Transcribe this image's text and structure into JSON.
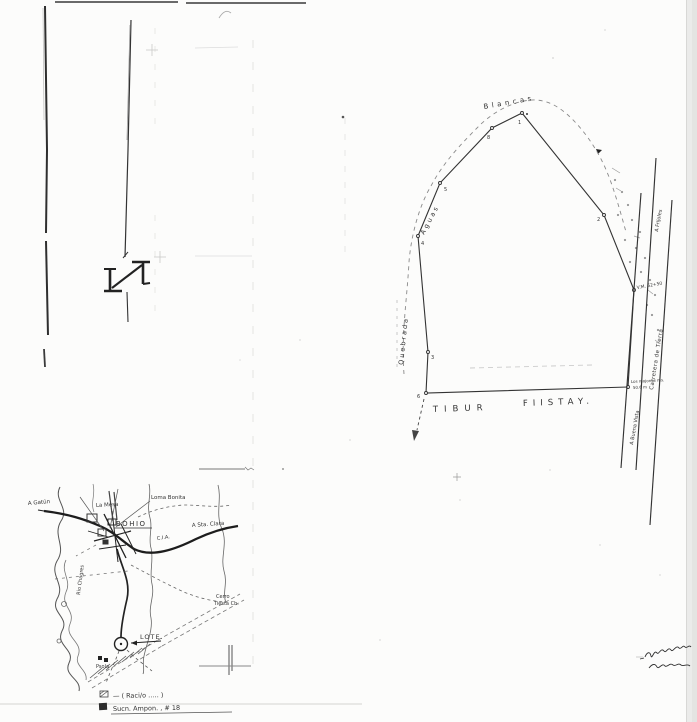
{
  "plat": {
    "creek_word_quebrada": "Quebrada",
    "creek_word_aguas": "Aguas",
    "creek_word_blancas": "Blancas",
    "adjoiner_word_1": "TIBUR",
    "adjoiner_word_2": "FIISTAY.",
    "road_name": "Carretera de Tierra",
    "road_dest_north": "A Frijoles",
    "road_dest_south": "A Buena Vista",
    "junction_note": "V.M. 62+50",
    "corner_note_1": "Los mojones ms.",
    "corner_note_2": "50.6 m",
    "v1": "1",
    "v2": "2",
    "v3": "3",
    "v4": "4",
    "v5": "5",
    "v6": "6",
    "v8": "8"
  },
  "map": {
    "town_name": "BOHIO",
    "label_loma_bonita": "Loma Bonita",
    "label_la_mesa": "La Mesa",
    "label_cia": "C.I.A.",
    "dest_east": "A Sta. Clara",
    "dest_west": "A Gatún",
    "label_rio": "Rio Chagres",
    "label_cerro_1": "Cerro",
    "label_cerro_2": "Tiesta Ch.",
    "label_lote": "LOTE.",
    "label_school": "Psola"
  },
  "legend": {
    "row1_text": "— ( Raci/o ….. )",
    "row2_text": "Sucn. Ampon. , # 18"
  }
}
